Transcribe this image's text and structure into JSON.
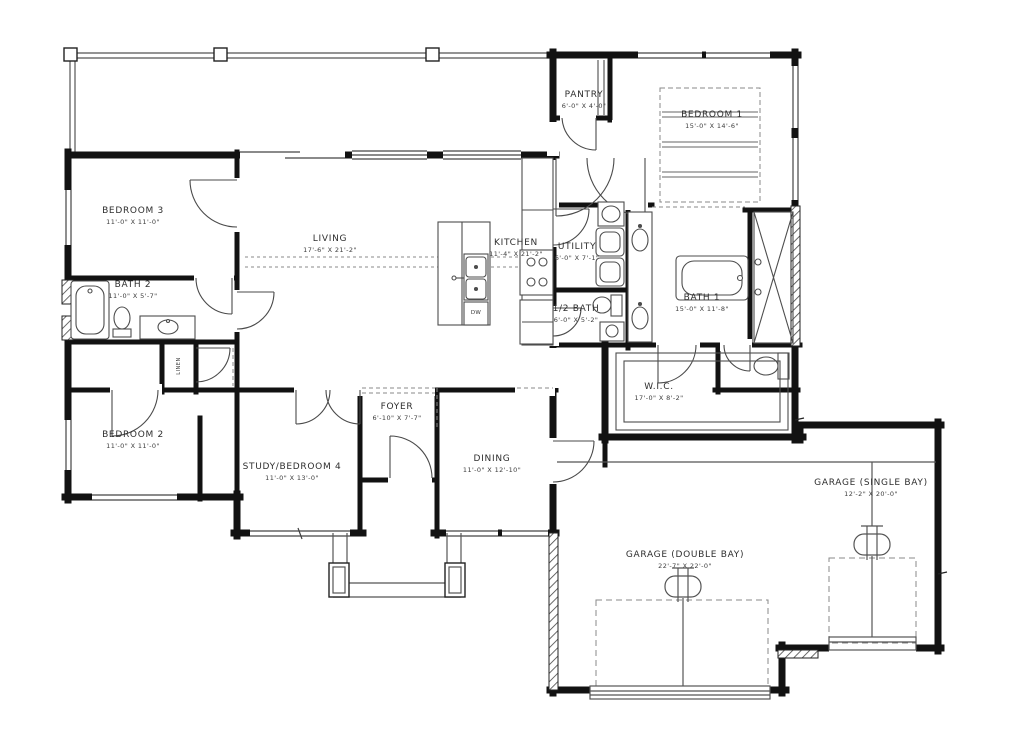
{
  "colors": {
    "walls": "#121212",
    "thin_lines": "#4d4d4d",
    "dashed_lines": "#7d7d7d",
    "background": "#ffffff"
  },
  "rooms": {
    "living": {
      "name": "LIVING",
      "dims": "17'-6\" X 21'-2\""
    },
    "kitchen": {
      "name": "KITCHEN",
      "dims": "11'-4\" X 21'-2\""
    },
    "pantry": {
      "name": "PANTRY",
      "dims": "6'-0\" X 4'-0\""
    },
    "bedroom1": {
      "name": "BEDROOM 1",
      "dims": "15'-0\" X 14'-6\""
    },
    "utility": {
      "name": "UTILITY",
      "dims": "6'-0\" X 7'-1\""
    },
    "half_bath": {
      "name": "1/2 BATH",
      "dims": "6'-0\" X 5'-2\""
    },
    "bath1": {
      "name": "BATH 1",
      "dims": "15'-0\" X 11'-8\""
    },
    "wic": {
      "name": "W.I.C.",
      "dims": "17'-0\" X 8'-2\""
    },
    "bedroom3": {
      "name": "BEDROOM 3",
      "dims": "11'-0\" X 11'-0\""
    },
    "bath2": {
      "name": "BATH 2",
      "dims": "11'-0\" X 5'-7\""
    },
    "bedroom2": {
      "name": "BEDROOM 2",
      "dims": "11'-0\" X 11'-0\""
    },
    "study": {
      "name": "STUDY/BEDROOM 4",
      "dims": "11'-0\" X 13'-0\""
    },
    "foyer": {
      "name": "FOYER",
      "dims": "6'-10\" X 7'-7\""
    },
    "dining": {
      "name": "DINING",
      "dims": "11'-0\" X 12'-10\""
    },
    "garage_double": {
      "name": "GARAGE (DOUBLE BAY)",
      "dims": "22'-7\" X 22'-0\""
    },
    "garage_single": {
      "name": "GARAGE (SINGLE BAY)",
      "dims": "12'-2\" X 20'-0\""
    },
    "linen": {
      "name": "LINEN"
    }
  },
  "labels": {
    "dishwasher": "DW"
  }
}
